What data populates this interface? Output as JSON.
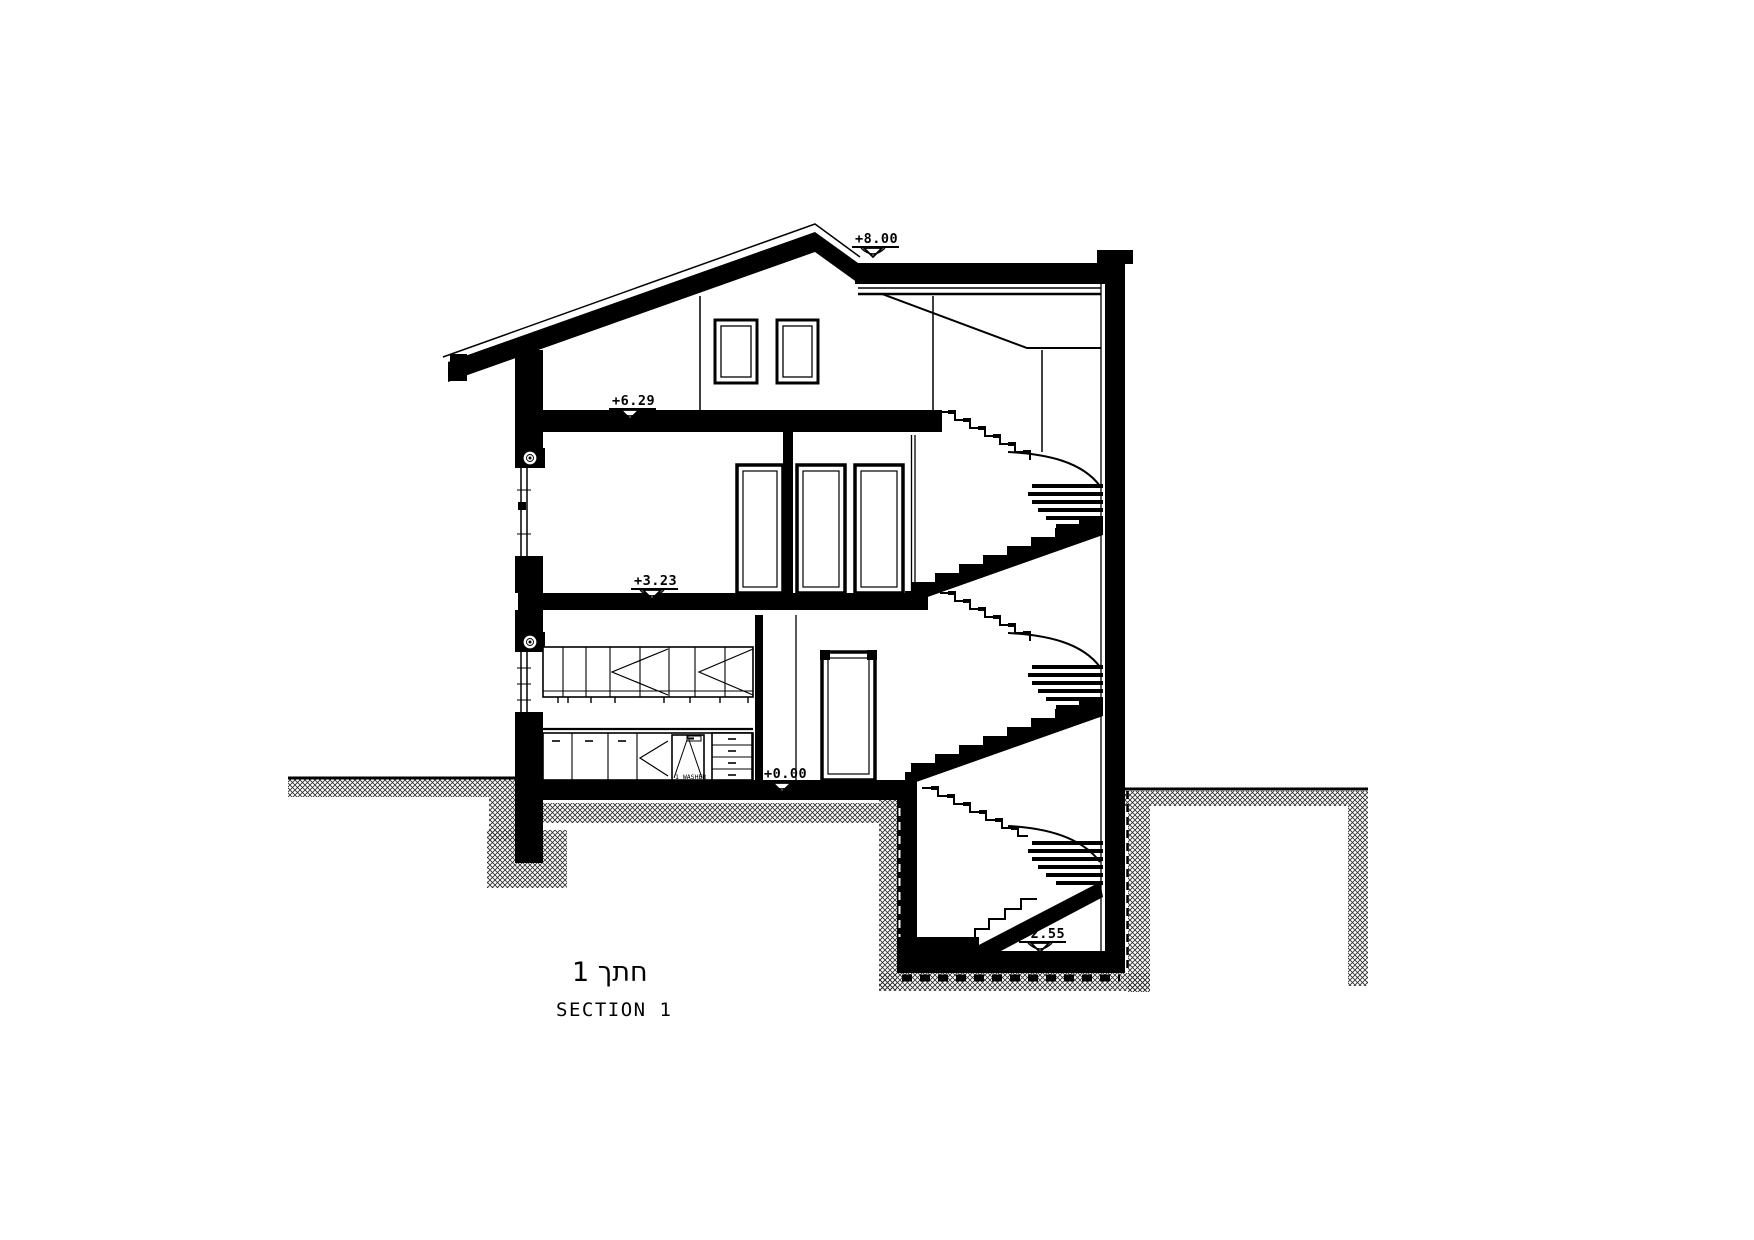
{
  "drawing": {
    "levels": {
      "roof": "+8.00",
      "attic_floor": "+6.29",
      "second_floor": "+3.23",
      "ground_floor": "+0.00",
      "basement_floor": "-2.55"
    },
    "kitchen": {
      "appliance_label": "1 WASHER"
    },
    "title": {
      "hebrew": "1  חתך",
      "english": "SECTION  1"
    },
    "colors": {
      "ink": "#000000",
      "paper": "#ffffff"
    }
  }
}
